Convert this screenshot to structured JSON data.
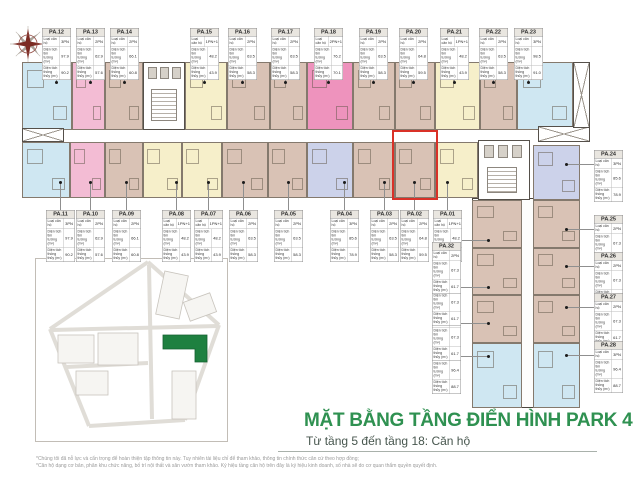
{
  "title_block": {
    "title": "MẶT BẰNG TẦNG ĐIỂN HÌNH PARK 4",
    "subtitle": "Từ tầng 5 đến tầng 18: Căn hộ"
  },
  "footnotes": [
    "*Chúng tôi đã nỗ lực và cẩn trọng để hoàn thiện tập thông tin này. Tuy nhiên tài liệu chỉ để tham khảo, thông tin chính thức căn cứ theo hợp đồng;",
    "*Căn hộ dạng cơ bản, phân khu chức năng, bố trí nội thất và sân vườn tham khảo. Ký hiệu tầng căn hộ trên đây là ký hiệu kinh doanh, số nhà sẽ do cơ quan thẩm quyền quyết định."
  ],
  "table_labels": {
    "row1": "Loại căn hộ",
    "row2": "Diện tích tim tường (m²)",
    "row3": "Diện tích thông thủy (m²)"
  },
  "legend_colors": {
    "blue": "#cfe7f2",
    "pink": "#f3bcd4",
    "hotpink": "#ee93bd",
    "tan": "#d9c2b5",
    "yellow": "#f6efca",
    "lavender": "#ccd2ea",
    "highlight_outline": "#d93128",
    "title_green": "#2f9151",
    "map_building_green": "#1e8040"
  },
  "highlighted_unit": "PA.02",
  "compass": {
    "icon": "compass-rose-icon"
  },
  "site_map": {
    "highlight_building": "PARK 4"
  },
  "units": [
    {
      "id": "PA.01",
      "color": "yellow",
      "bedrooms": "1PN+1",
      "area_gross": "48.2",
      "area_net": "43.9"
    },
    {
      "id": "PA.02",
      "color": "tan",
      "bedrooms": "2PN",
      "area_gross": "64.8",
      "area_net": "59.5"
    },
    {
      "id": "PA.03",
      "color": "tan",
      "bedrooms": "2PN",
      "area_gross": "63.5",
      "area_net": "58.3"
    },
    {
      "id": "PA.04",
      "color": "lavender",
      "bedrooms": "3PN",
      "area_gross": "85.6",
      "area_net": "78.9"
    },
    {
      "id": "PA.05",
      "color": "tan",
      "bedrooms": "2PN",
      "area_gross": "63.5",
      "area_net": "58.3"
    },
    {
      "id": "PA.06",
      "color": "tan",
      "bedrooms": "2PN",
      "area_gross": "63.5",
      "area_net": "58.3"
    },
    {
      "id": "PA.07",
      "color": "yellow",
      "bedrooms": "1PN+1",
      "area_gross": "48.2",
      "area_net": "43.9"
    },
    {
      "id": "PA.08",
      "color": "yellow",
      "bedrooms": "1PN+1",
      "area_gross": "48.2",
      "area_net": "43.9"
    },
    {
      "id": "PA.09",
      "color": "tan",
      "bedrooms": "2PN",
      "area_gross": "66.1",
      "area_net": "60.8"
    },
    {
      "id": "PA.10",
      "color": "pink",
      "bedrooms": "2PN",
      "area_gross": "62.9",
      "area_net": "57.6"
    },
    {
      "id": "PA.11",
      "color": "blue",
      "bedrooms": "3PN",
      "area_gross": "97.9",
      "area_net": "90.2"
    },
    {
      "id": "PA.12",
      "color": "blue",
      "bedrooms": "3PN",
      "area_gross": "97.9",
      "area_net": "90.2"
    },
    {
      "id": "PA.13",
      "color": "pink",
      "bedrooms": "2PN",
      "area_gross": "62.9",
      "area_net": "57.6"
    },
    {
      "id": "PA.14",
      "color": "tan",
      "bedrooms": "2PN",
      "area_gross": "66.1",
      "area_net": "60.8"
    },
    {
      "id": "PA.15",
      "color": "yellow",
      "bedrooms": "1PN+1",
      "area_gross": "48.2",
      "area_net": "43.9"
    },
    {
      "id": "PA.16",
      "color": "tan",
      "bedrooms": "2PN",
      "area_gross": "63.5",
      "area_net": "58.3"
    },
    {
      "id": "PA.17",
      "color": "tan",
      "bedrooms": "2PN",
      "area_gross": "63.5",
      "area_net": "58.3"
    },
    {
      "id": "PA.18",
      "color": "hotpink",
      "bedrooms": "2PN+1",
      "area_gross": "76.2",
      "area_net": "70.1"
    },
    {
      "id": "PA.19",
      "color": "tan",
      "bedrooms": "2PN",
      "area_gross": "63.5",
      "area_net": "58.3"
    },
    {
      "id": "PA.20",
      "color": "tan",
      "bedrooms": "2PN",
      "area_gross": "64.8",
      "area_net": "59.5"
    },
    {
      "id": "PA.21",
      "color": "yellow",
      "bedrooms": "1PN+1",
      "area_gross": "48.2",
      "area_net": "43.9"
    },
    {
      "id": "PA.22",
      "color": "tan",
      "bedrooms": "2PN",
      "area_gross": "63.5",
      "area_net": "58.3"
    },
    {
      "id": "PA.23",
      "color": "blue",
      "bedrooms": "3PN",
      "area_gross": "98.5",
      "area_net": "91.0"
    },
    {
      "id": "PA.24",
      "color": "lavender",
      "bedrooms": "3PN",
      "area_gross": "85.6",
      "area_net": "78.9"
    },
    {
      "id": "PA.25",
      "color": "tan",
      "bedrooms": "2PN",
      "area_gross": "67.3",
      "area_net": "61.7"
    },
    {
      "id": "PA.26",
      "color": "tan",
      "bedrooms": "2PN",
      "area_gross": "67.3",
      "area_net": "61.7"
    },
    {
      "id": "PA.27",
      "color": "tan",
      "bedrooms": "2PN",
      "area_gross": "67.3",
      "area_net": "61.7"
    },
    {
      "id": "PA.28",
      "color": "blue",
      "bedrooms": "3PN",
      "area_gross": "96.4",
      "area_net": "88.7"
    },
    {
      "id": "PA.29",
      "color": "blue",
      "bedrooms": "3PN",
      "area_gross": "96.4",
      "area_net": "88.7"
    },
    {
      "id": "PA.30",
      "color": "tan",
      "bedrooms": "2PN",
      "area_gross": "67.3",
      "area_net": "61.7"
    },
    {
      "id": "PA.31",
      "color": "tan",
      "bedrooms": "2PN",
      "area_gross": "67.3",
      "area_net": "61.7"
    },
    {
      "id": "PA.32",
      "color": "tan",
      "bedrooms": "2PN",
      "area_gross": "67.3",
      "area_net": "61.7"
    }
  ]
}
